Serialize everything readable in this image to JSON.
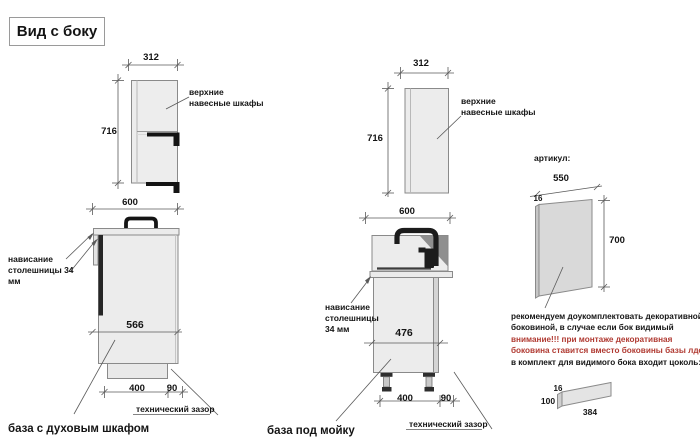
{
  "title": "Вид с боку",
  "annotations": {
    "upper_cabinets_label": "верхние навесные шкафы",
    "countertop_overhang_label": "нависание столешницы 34 мм",
    "tech_gap_label": "технический зазор",
    "article_label": "артикул:"
  },
  "oven_unit": {
    "upper": {
      "width": "312",
      "height": "716"
    },
    "base": {
      "width": "600",
      "interior_width": "566",
      "plinth_width": "400",
      "tech_gap": "90"
    },
    "caption": "база с духовым шкафом"
  },
  "sink_unit": {
    "upper": {
      "width": "312",
      "height": "716"
    },
    "base": {
      "width": "600",
      "interior_width": "476",
      "plinth_width": "400",
      "tech_gap": "90"
    },
    "caption": "база под мойку"
  },
  "decor_panel": {
    "width": "550",
    "thickness": "16",
    "height": "700"
  },
  "plinth_board": {
    "thickness": "16",
    "height": "100",
    "length": "384"
  },
  "note": {
    "line1": "рекомендуем доукомплектовать декоративной",
    "line2": "боковиной, в случае если бок видимый",
    "line3": "внимание!!! при монтаже декоративная",
    "line4": "боковина ставится вместо боковины базы лдсп",
    "line5": "в комплект для видимого бока входит цоколь:"
  },
  "colors": {
    "warning_red": "#b03a32",
    "line_gray": "#8a8a8a",
    "cabinet_fill": "#ececec",
    "dark": "#1c1c1c"
  }
}
